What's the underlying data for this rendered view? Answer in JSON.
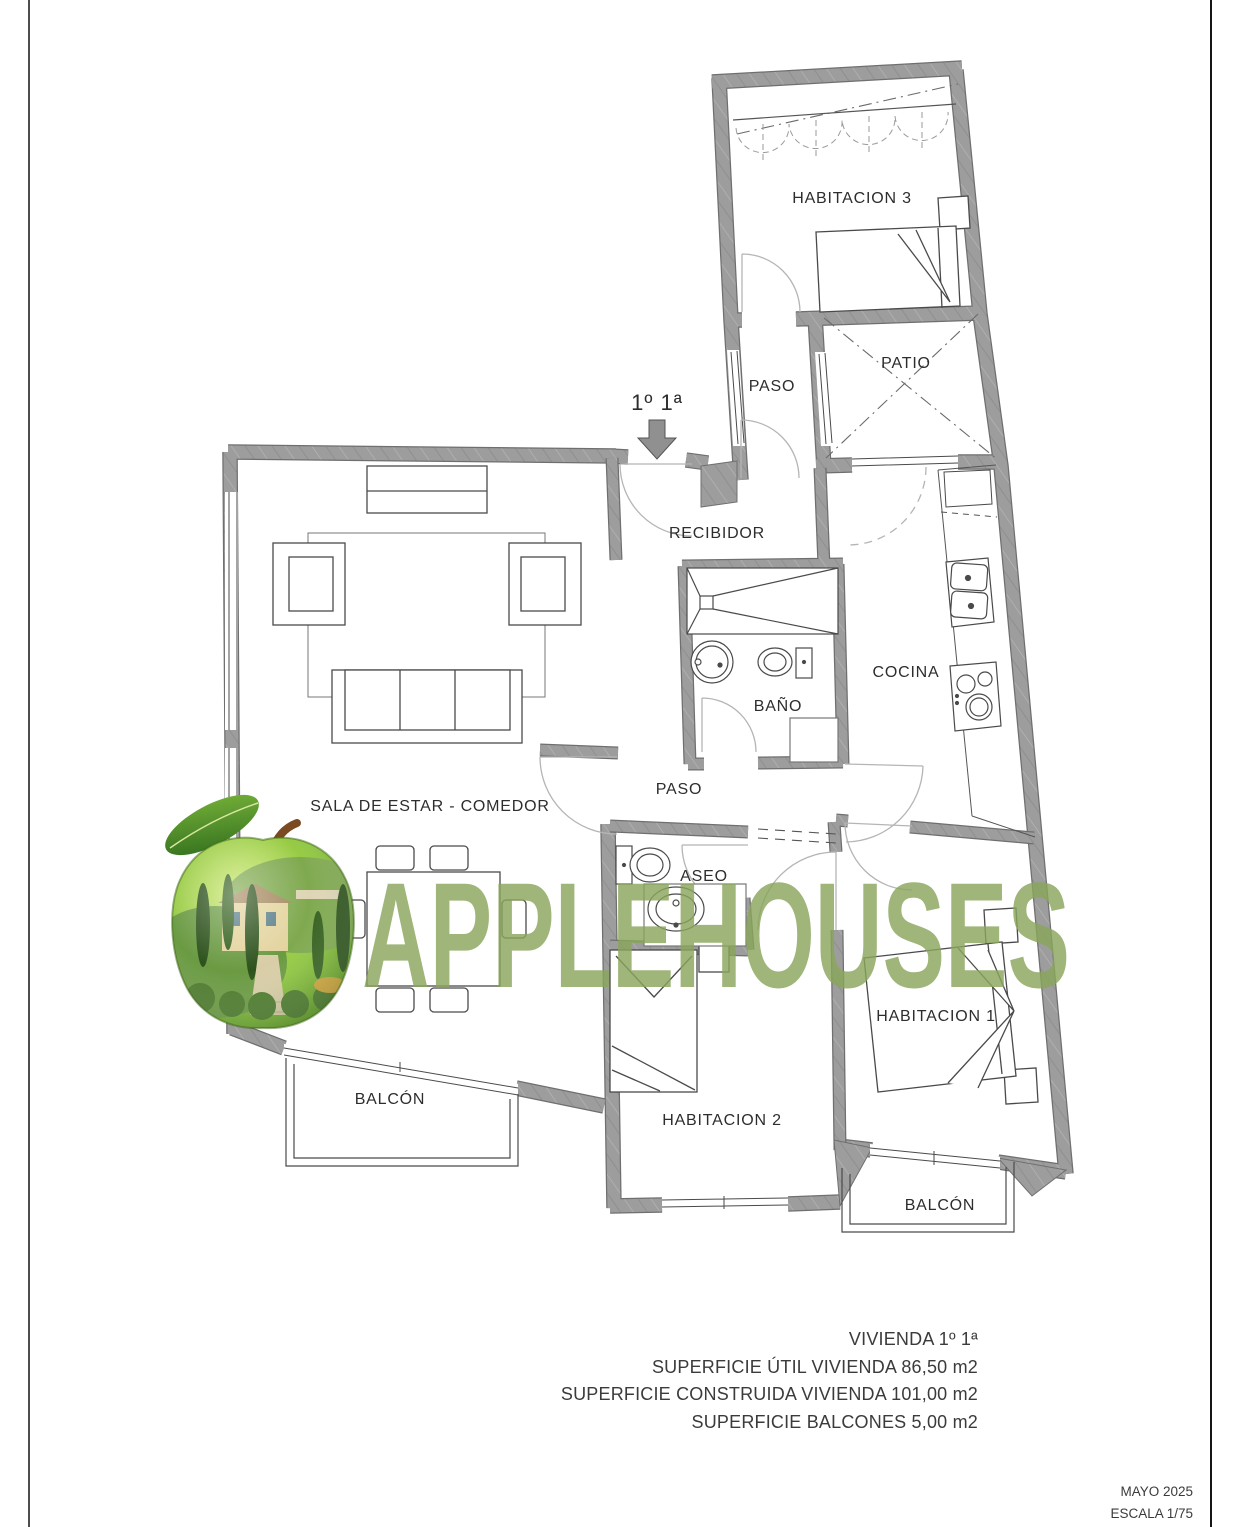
{
  "plan": {
    "unit_label": "1º 1ª",
    "rooms": {
      "habitacion3": "HABITACION 3",
      "paso_top": "PASO",
      "patio": "PATIO",
      "recibidor": "RECIBIDOR",
      "bano": "BAÑO",
      "cocina": "COCINA",
      "paso_mid": "PASO",
      "sala": "SALA DE ESTAR - COMEDOR",
      "aseo": "ASEO",
      "habitacion1": "HABITACION 1",
      "habitacion2": "HABITACION 2",
      "balcon_left": "BALCÓN",
      "balcon_right": "BALCÓN"
    }
  },
  "watermark": {
    "brand": "APPLEHOUSES",
    "logo": "apple-garden-logo",
    "color": "#8aa65c"
  },
  "summary": {
    "lines": [
      "VIVIENDA 1º 1ª",
      "SUPERFICIE ÚTIL VIVIENDA 86,50 m2",
      "SUPERFICIE CONSTRUIDA VIVIENDA 101,00 m2",
      "SUPERFICIE BALCONES 5,00 m2"
    ]
  },
  "titleblock": {
    "date": "MAYO 2025",
    "scale": "ESCALA 1/75"
  },
  "colors": {
    "wall": "#9d9d9d",
    "line": "#4a4a4a",
    "watermark": "#8aa65c"
  }
}
